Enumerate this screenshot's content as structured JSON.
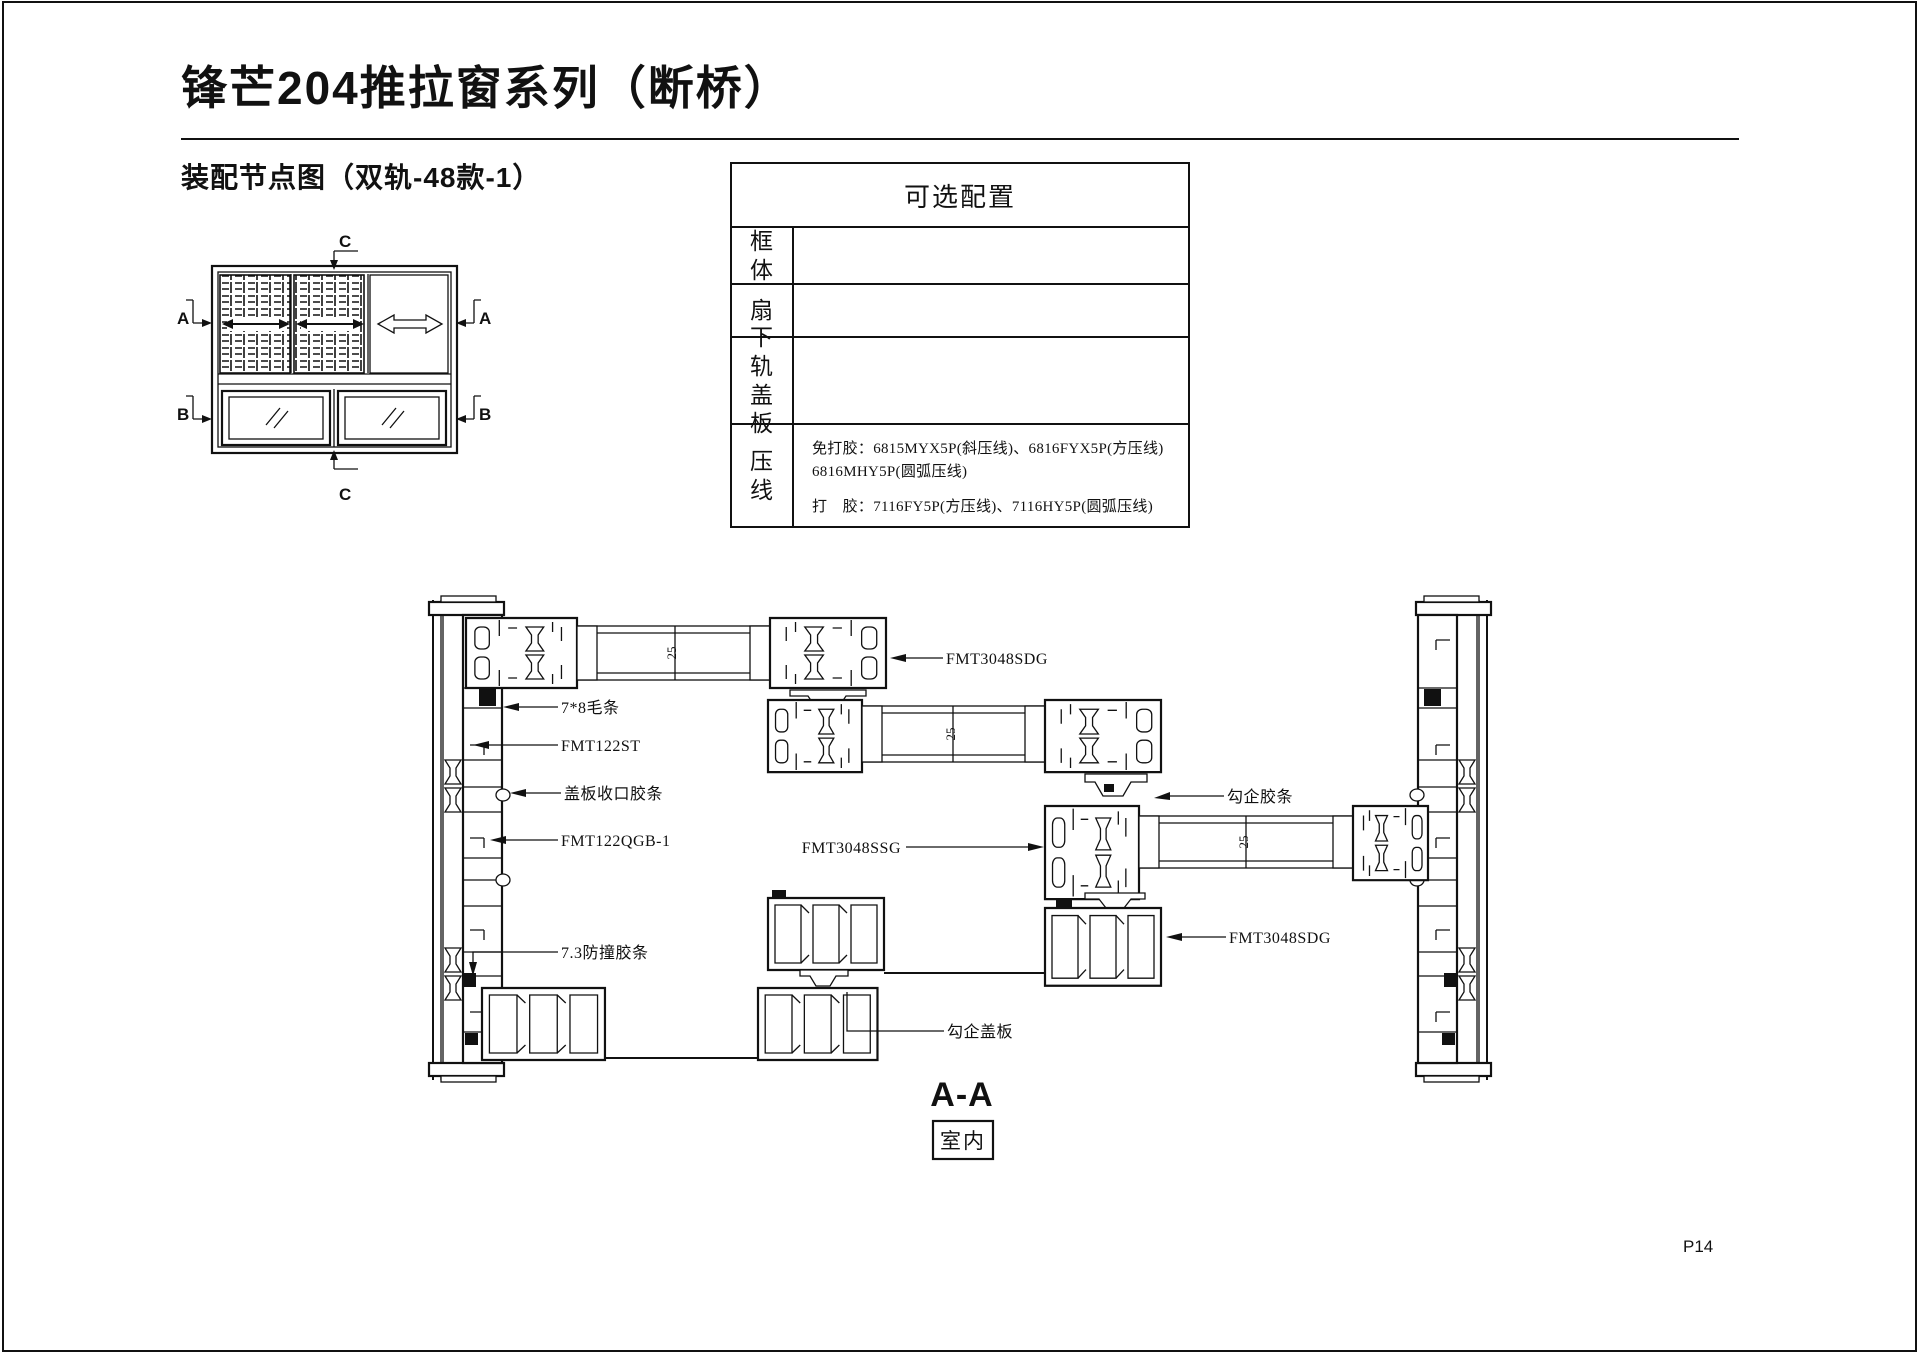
{
  "page": {
    "title": "锋芒204推拉窗系列（断桥）",
    "subtitle": "装配节点图（双轨-48款-1）",
    "page_number": "P14"
  },
  "config_table": {
    "title": "可选配置",
    "rows": [
      {
        "label": "框体",
        "value": ""
      },
      {
        "label": "扇",
        "value": ""
      },
      {
        "label": "下轨盖板",
        "value": ""
      },
      {
        "label": "压线",
        "value": ""
      }
    ],
    "pressline": {
      "line1": "免打胶：6815MYX5P(斜压线)、6816FYX5P(方压线)",
      "line2": "6816MHY5P(圆弧压线)",
      "line3": "打　胶：7116FY5P(方压线)、7116HY5P(圆弧压线)"
    }
  },
  "schematic": {
    "section_a": "A",
    "section_b": "B",
    "section_c": "C"
  },
  "drawing": {
    "glass_thickness": "25",
    "section_title": "A-A",
    "interior_label": "室内",
    "labels": {
      "top_sash": "FMT3048SDG",
      "brush": "7*8毛条",
      "fmt122st": "FMT122ST",
      "cover_gasket": "盖板收口胶条",
      "fmt122qgb": "FMT122QGB-1",
      "bumper": "7.3防撞胶条",
      "hook_gasket": "勾企胶条",
      "ssg": "FMT3048SSG",
      "bottom_rail": "FMT3048SDG",
      "hook_cover": "勾企盖板"
    }
  }
}
